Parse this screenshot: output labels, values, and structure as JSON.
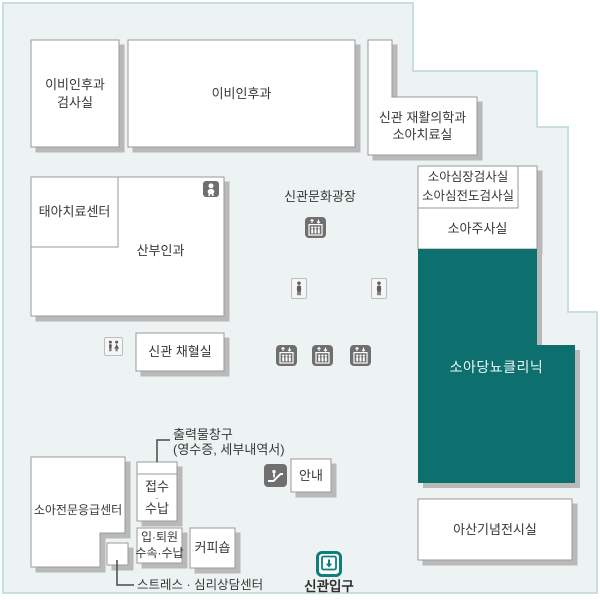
{
  "map": {
    "rooms": {
      "ent_lab": {
        "line1": "이비인후과",
        "line2": "검사실"
      },
      "ent": {
        "label": "이비인후과"
      },
      "rehab": {
        "line1": "신관 재활의학과",
        "line2": "소아치료실"
      },
      "fetal_center": {
        "label": "태아치료센터"
      },
      "obgyn": {
        "label": "산부인과"
      },
      "cardiac_lab": {
        "line1": "소아심장검사실",
        "line2": "소아심전도검사실"
      },
      "injection_room": {
        "label": "소아주사실"
      },
      "diabetes_clinic": {
        "label": "소아당뇨클리닉"
      },
      "blood_lab": {
        "label": "신관 채혈실"
      },
      "emergency_center": {
        "label": "소아전문응급센터"
      },
      "reception": {
        "line1": "접수",
        "dot": "·",
        "line2": "수납"
      },
      "admission": {
        "line1": "입·퇴원",
        "line2": "수속·수납"
      },
      "coffee_shop": {
        "label": "커피숍"
      },
      "info_desk": {
        "label": "안내"
      },
      "stress_center": {
        "label": "스트레스 · 심리상담센터"
      },
      "exhibit_hall": {
        "label": "아산기념전시실"
      }
    },
    "labels": {
      "plaza": "신관문화광장",
      "printout_line1": "출력물창구",
      "printout_line2": "(영수증, 세부내역서)",
      "entrance": "신관입구"
    },
    "icons": {
      "baby_care": "baby-care-icon",
      "elevator": "elevator-icon",
      "restroom": "restroom-icon",
      "person": "person-icon",
      "escalator": "escalator-icon",
      "entrance": "entrance-icon"
    },
    "colors": {
      "floor_background": "#edf3f2",
      "floor_border": "#c8dfdf",
      "room_border": "#9a9a9a",
      "room_shadow": "#b9b9b9",
      "highlight_teal": "#11706e",
      "entrance_teal": "#0e7f7d",
      "icon_gray": "#6f6f6f",
      "text": "#383838"
    }
  }
}
